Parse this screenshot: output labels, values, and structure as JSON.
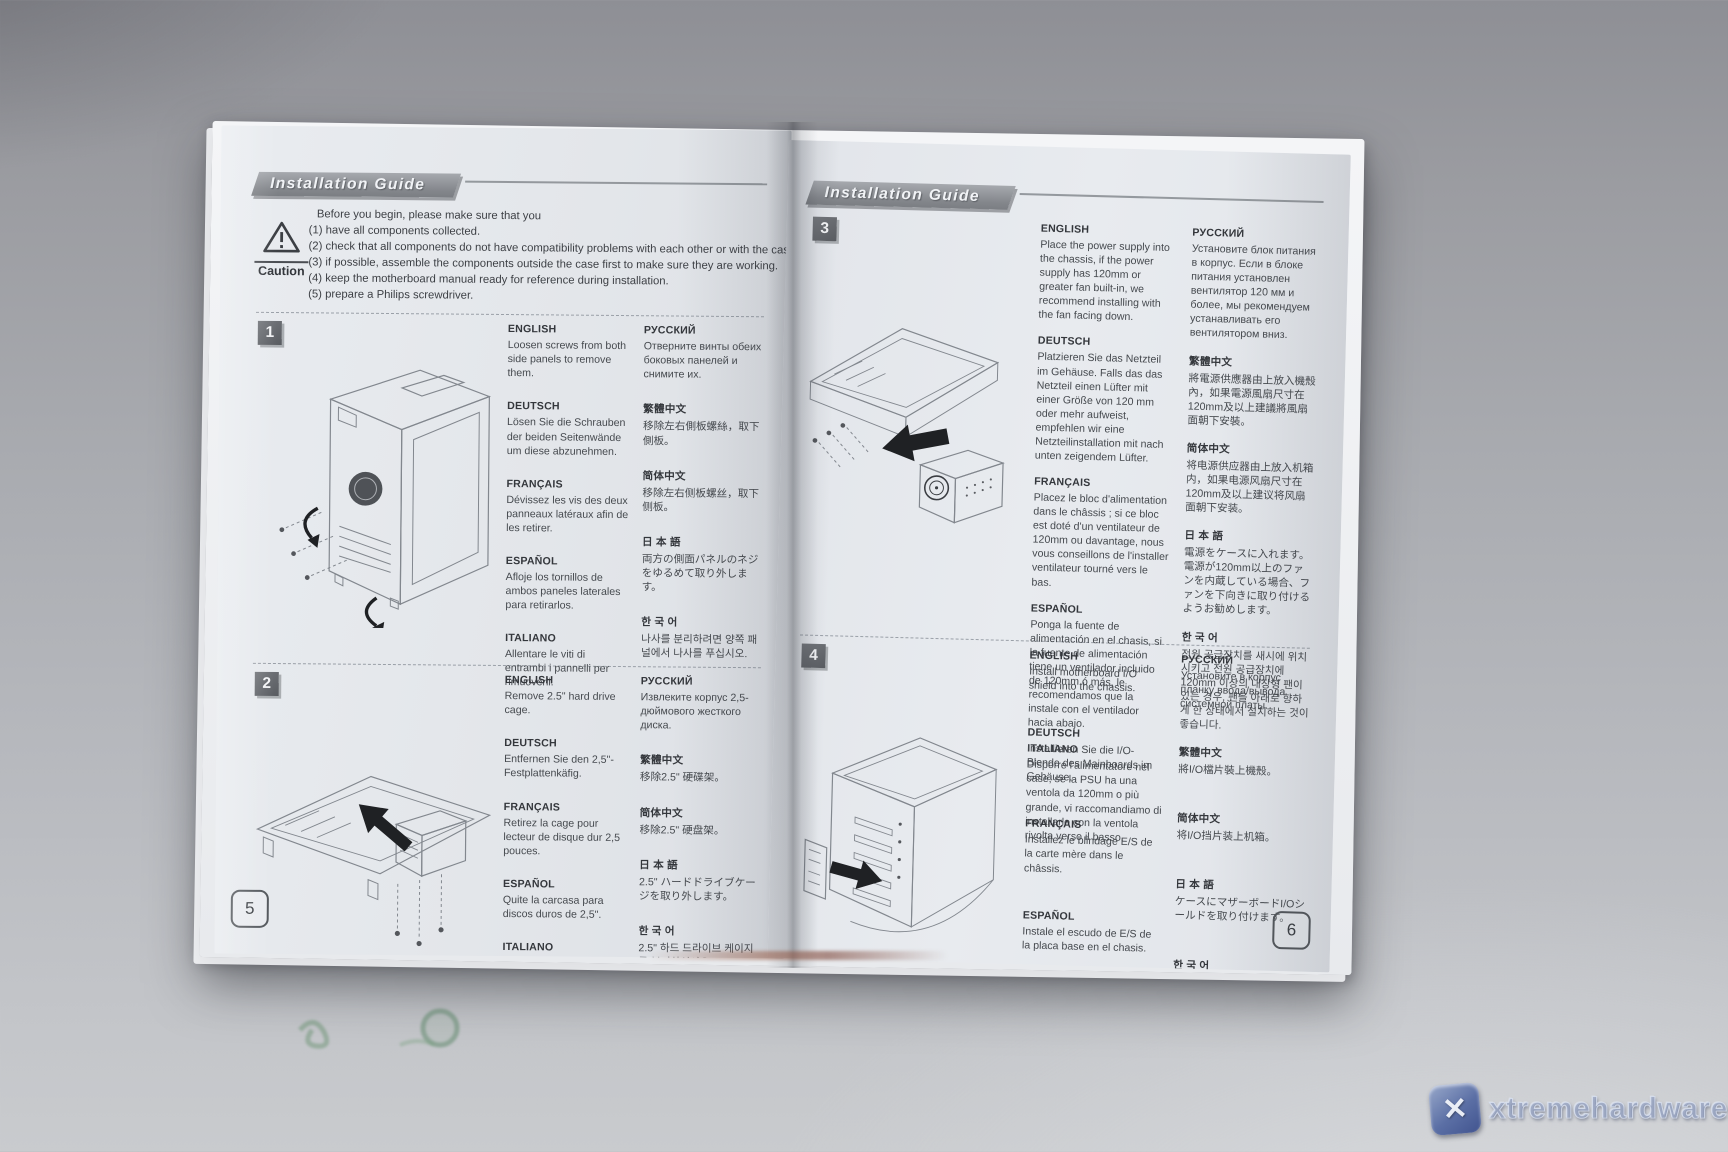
{
  "watermark": {
    "text": "xtremehardware.it",
    "logo_glyph": "✕",
    "tile_color": "#41548f"
  },
  "left_page": {
    "header": "Installation Guide",
    "caution_label": "Caution",
    "page_number": "5",
    "intro": [
      "Before you begin, please make sure that you",
      "(1) have all components collected.",
      "(2) check that all components do not have compatibility problems with each other or with the case.",
      "(3) if possible, assemble the components outside the case first to make sure they are working.",
      "(4) keep the motherboard manual ready for reference during installation.",
      "(5) prepare a Philips screwdriver."
    ],
    "steps": [
      {
        "number": "1",
        "col_a": [
          {
            "label": "ENGLISH",
            "text": "Loosen screws from both side panels to remove them."
          },
          {
            "label": "DEUTSCH",
            "text": "Lösen Sie die Schrauben der beiden Seitenwände um diese abzunehmen."
          },
          {
            "label": "FRANÇAIS",
            "text": "Dévissez les vis des deux panneaux latéraux afin de les retirer."
          },
          {
            "label": "ESPAÑOL",
            "text": "Afloje los tornillos de ambos paneles laterales para retirarlos."
          },
          {
            "label": "ITALIANO",
            "text": "Allentare le viti di entrambi i pannelli per rimuoverli."
          }
        ],
        "col_b": [
          {
            "label": "РУССКИЙ",
            "text": "Отверните винты обеих боковых панелей и снимите их."
          },
          {
            "label": "繁體中文",
            "text": "移除左右側板螺絲，取下側板。"
          },
          {
            "label": "简体中文",
            "text": "移除左右侧板螺丝，取下侧板。"
          },
          {
            "label": "日 本 語",
            "text": "両方の側面パネルのネジをゆるめて取り外します。"
          },
          {
            "label": "한 국 어",
            "text": "나사를 분리하려면 양쪽 패널에서 나사를 푸십시오."
          }
        ]
      },
      {
        "number": "2",
        "col_a": [
          {
            "label": "ENGLISH",
            "text": "Remove 2.5\" hard drive cage."
          },
          {
            "label": "DEUTSCH",
            "text": "Entfernen Sie den 2,5\"-Festplattenkäfig."
          },
          {
            "label": "FRANÇAIS",
            "text": "Retirez la cage pour lecteur de disque dur 2,5 pouces."
          },
          {
            "label": "ESPAÑOL",
            "text": "Quite la carcasa para discos duros de 2,5\"."
          },
          {
            "label": "ITALIANO",
            "text": "Rimuovere il supporto degli hard disk da 2,5\""
          }
        ],
        "col_b": [
          {
            "label": "РУССКИЙ",
            "text": "Извлеките корпус 2,5-дюймового жесткого диска."
          },
          {
            "label": "繁體中文",
            "text": "移除2.5\" 硬碟架。"
          },
          {
            "label": "简体中文",
            "text": "移除2.5\" 硬盘架。"
          },
          {
            "label": "日 本 語",
            "text": "2.5\" ハードドライブケージを取り外します。"
          },
          {
            "label": "한 국 어",
            "text": "2.5\" 하드 드라이브 케이지를 분리하십시오."
          }
        ]
      }
    ]
  },
  "right_page": {
    "header": "Installation Guide",
    "page_number": "6",
    "steps": [
      {
        "number": "3",
        "col_a": [
          {
            "label": "ENGLISH",
            "text": "Place the power supply into the chassis, if the power supply has 120mm or greater fan built-in, we recommend installing with the fan facing down."
          },
          {
            "label": "DEUTSCH",
            "text": "Platzieren Sie das Netzteil im Gehäuse. Falls das das Netzteil einen Lüfter mit einer Größe von 120 mm oder mehr aufweist, empfehlen wir eine Netzteilinstallation mit nach unten zeigendem Lüfter."
          },
          {
            "label": "FRANÇAIS",
            "text": "Placez le bloc d'alimentation dans le châssis ; si ce bloc est doté d'un ventilateur de 120mm ou davantage, nous vous conseillons de l'installer ventilateur tourné vers le bas."
          },
          {
            "label": "ESPAÑOL",
            "text": "Ponga la fuente de alimentación en el chasis, si la fuente de alimentación tiene un ventilador incluido de 120mm ó más, le recomendamos que la instale con el ventilador hacia abajo."
          },
          {
            "label": "ITALIANO",
            "text": "Disporre l'alimentatore nel case, se la PSU ha una ventola da 120mm o più grande, vi raccomandiamo di installarlo con la ventola rivolta verso il basso."
          }
        ],
        "col_b": [
          {
            "label": "РУССКИЙ",
            "text": "Установите блок питания в корпус. Если в блоке питания установлен вентилятор 120 мм и более, мы рекомендуем устанавливать его вентилятором вниз."
          },
          {
            "label": "繁體中文",
            "text": "將電源供應器由上放入機殼內，如果電源風扇尺寸在120mm及以上建議將風扇面朝下安裝。"
          },
          {
            "label": "简体中文",
            "text": "将电源供应器由上放入机箱内，如果电源风扇尺寸在120mm及以上建议将风扇面朝下安装。"
          },
          {
            "label": "日 本 語",
            "text": "電源をケースに入れます。電源が120mm以上のファンを内蔵している場合、ファンを下向きに取り付けるようお勧めします。"
          },
          {
            "label": "한 국 어",
            "text": "전원 공급장치를 새시에 위치시키고 전원 공급장치에 120mm 이상의 내장형 팬이 있는 경우, 팬을 아래로 향하게 한 상태에서 설치하는 것이 좋습니다."
          }
        ]
      },
      {
        "number": "4",
        "col_a": [
          {
            "label": "ENGLISH",
            "text": "Install motherboard I/O shield into the chassis."
          },
          {
            "label": "DEUTSCH",
            "text": "Installieren Sie die I/O-Blende des Mainboards im Gehäuse."
          },
          {
            "label": "FRANÇAIS",
            "text": "Installez le blindage E/S de la carte mère dans le châssis."
          },
          {
            "label": "ESPAÑOL",
            "text": "Instale el escudo de E/S de la placa base en el chasis."
          },
          {
            "label": "ITALIANO",
            "text": "Installare il pannellino I/O della scheda madre nel case."
          }
        ],
        "col_b": [
          {
            "label": "РУССКИЙ",
            "text": "Установите в корпус планку ввода/вывода системной платы."
          },
          {
            "label": "繁體中文",
            "text": "將I/O檔片裝上機殼。"
          },
          {
            "label": "简体中文",
            "text": "将I/O挡片装上机箱。"
          },
          {
            "label": "日 本 語",
            "text": "ケースにマザーボードI/Oシールドを取り付けます。"
          },
          {
            "label": "한 국 어",
            "text": "메인보드 I/O 쉴드를 새시에 설치하십시오."
          }
        ]
      }
    ]
  }
}
